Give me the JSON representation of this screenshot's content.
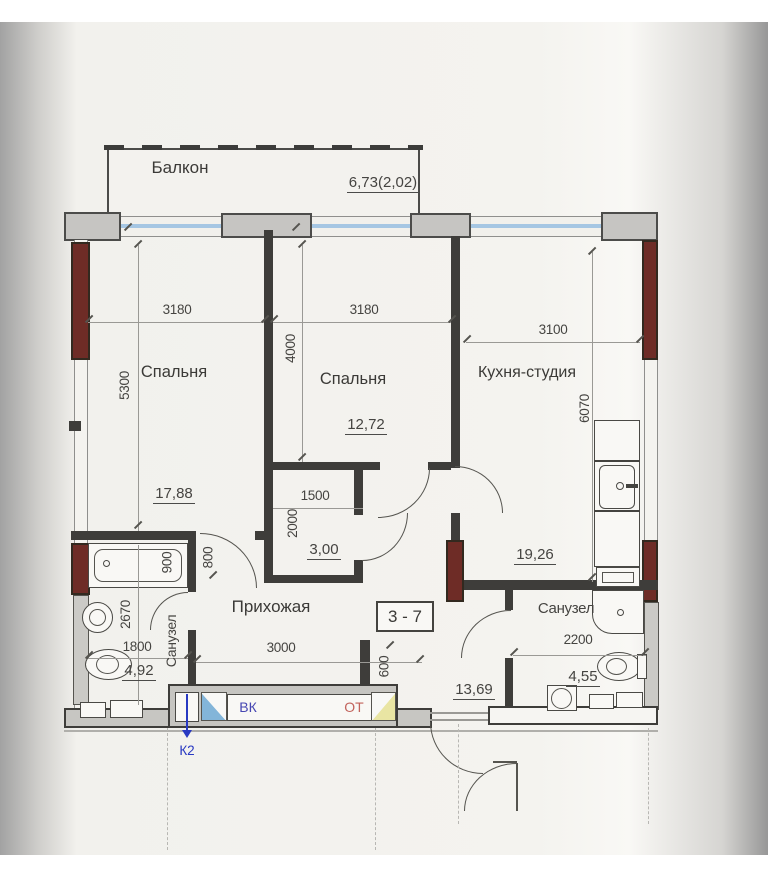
{
  "balcony": {
    "label": "Балкон",
    "area": "6,73(2,02)"
  },
  "rooms": {
    "bedroom1": {
      "label": "Спальня",
      "area": "17,88",
      "width_mm": "3180",
      "depth_mm": "5300"
    },
    "bedroom2": {
      "label": "Спальня",
      "area": "12,72",
      "width_mm": "3180",
      "depth_mm": "4000"
    },
    "kitchen": {
      "label": "Кухня-студия",
      "area": "19,26",
      "width_mm": "3100",
      "depth_mm": "6070"
    },
    "closet": {
      "area": "3,00",
      "width_mm": "1500",
      "depth_mm": "2000"
    },
    "hallway": {
      "label": "Прихожая",
      "area": "13,69",
      "width_mm": "3000",
      "door_mm": "800",
      "niche_mm": "600"
    },
    "bathroom_left": {
      "label": "Санузел",
      "area": "4,92",
      "width_mm": "1800",
      "depth_mm": "2670",
      "tub_mm": "900"
    },
    "bathroom_right": {
      "label": "Санузел",
      "area": "4,55",
      "width_mm": "2200"
    }
  },
  "apartment_number": "3 - 7",
  "utilities": {
    "water": "ВК",
    "heating": "ОТ",
    "sewer": "К2"
  },
  "colors": {
    "pillar": "#6e2c26",
    "glazing": "#a5c6e3",
    "wall": "#3e3d3a",
    "water_label": "#4747b2",
    "heating_label": "#c2635c",
    "sewer_label": "#2839c2"
  }
}
